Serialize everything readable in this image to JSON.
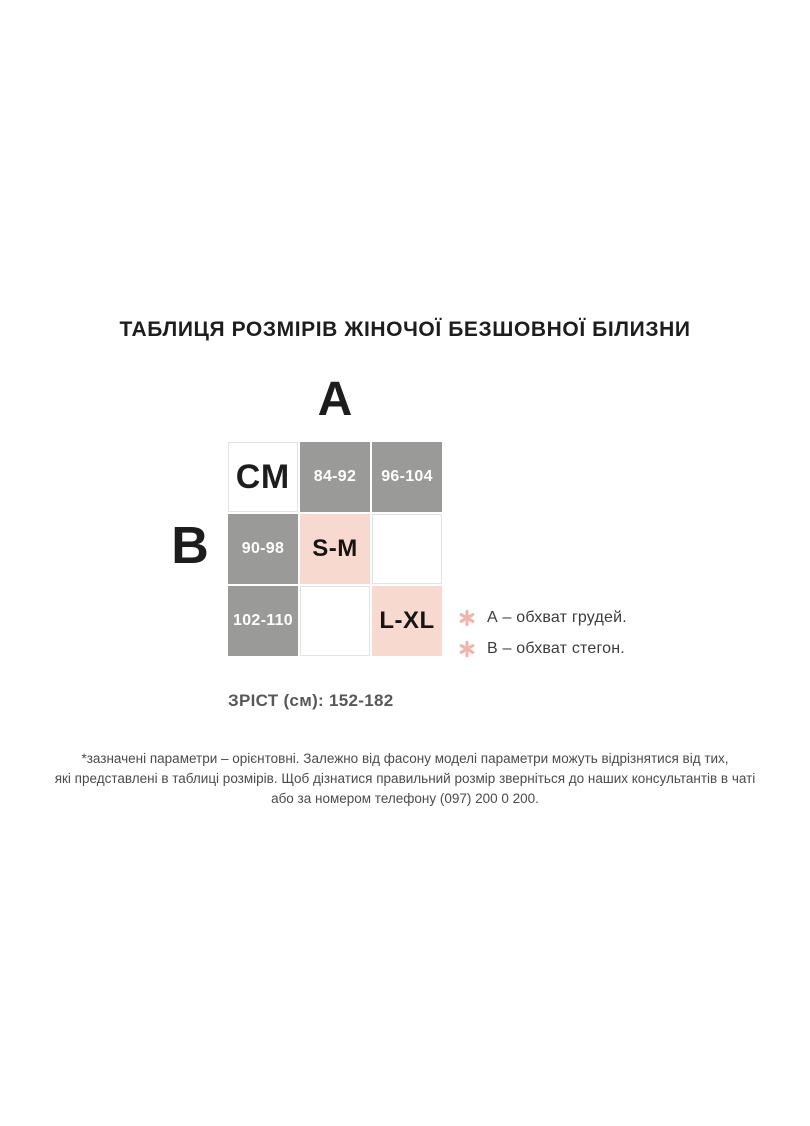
{
  "chart_data": {
    "type": "table",
    "title": "ТАБЛИЦЯ РОЗМІРІВ ЖІНОЧОЇ БЕЗШОВНОЇ БІЛИЗНИ",
    "column_axis_label": "А",
    "row_axis_label": "В",
    "unit_cell": "СМ",
    "column_headers": [
      "84-92",
      "96-104"
    ],
    "row_headers": [
      "90-98",
      "102-110"
    ],
    "matrix": [
      [
        "S-M",
        ""
      ],
      [
        "",
        "L-XL"
      ]
    ],
    "cells": [
      {
        "text": "СМ",
        "role": "unit"
      },
      {
        "text": "84-92",
        "role": "column-header"
      },
      {
        "text": "96-104",
        "role": "column-header"
      },
      {
        "text": "90-98",
        "role": "row-header"
      },
      {
        "text": "S-M",
        "role": "size-value"
      },
      {
        "text": "",
        "role": "empty"
      },
      {
        "text": "102-110",
        "role": "row-header"
      },
      {
        "text": "",
        "role": "empty"
      },
      {
        "text": "L-XL",
        "role": "size-value"
      }
    ],
    "legend": [
      {
        "icon": "asterisk-icon",
        "text": "А – обхват грудей."
      },
      {
        "icon": "asterisk-icon",
        "text": "В – обхват стегон."
      }
    ],
    "height_note": "ЗРІСТ (см): 152-182",
    "layout_hints": {
      "grid": "3x3",
      "legend_position": "right-of-table"
    }
  },
  "footer": {
    "lines": [
      "*зазначені параметри – орієнтовні. Залежно від фасону моделі параметри можуть відрізнятися від тих,",
      "які представлені в таблиці розмірів. Щоб дізнатися правильний розмір зверніться до наших консультантів в чаті",
      "або за номером телефону (097) 200 0 200."
    ]
  },
  "colors": {
    "header_gray": "#9a9a98",
    "size_pink": "#f8d9cf",
    "asterisk_pink": "#f0b6ae",
    "text_dark": "#1d1d1d",
    "text_gray": "#58585a",
    "footer_text": "#4b4b4b",
    "empty_cell_border": "#e3e3e3"
  }
}
